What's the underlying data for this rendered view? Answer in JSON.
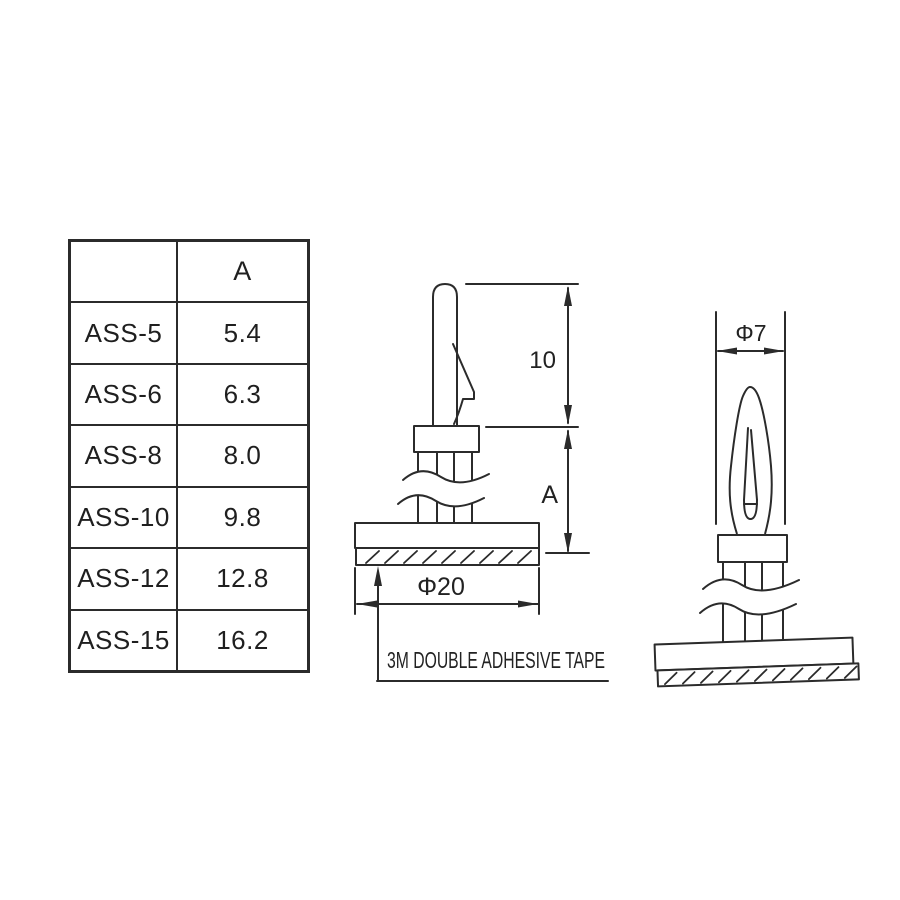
{
  "table": {
    "header": {
      "col1": "",
      "col2": "A"
    },
    "rows": [
      {
        "model": "ASS-5",
        "a": "5.4"
      },
      {
        "model": "ASS-6",
        "a": "6.3"
      },
      {
        "model": "ASS-8",
        "a": "8.0"
      },
      {
        "model": "ASS-10",
        "a": "9.8"
      },
      {
        "model": "ASS-12",
        "a": "12.8"
      },
      {
        "model": "ASS-15",
        "a": "16.2"
      }
    ]
  },
  "front_view": {
    "dim_top_height": "10",
    "dim_body_height": "A",
    "dim_base_diameter": "Φ20",
    "tape_label": "3M DOUBLE ADHESIVE TAPE"
  },
  "side_view": {
    "dim_width": "Φ7"
  },
  "colors": {
    "ink": "#2b2b2b",
    "background": "#ffffff"
  }
}
